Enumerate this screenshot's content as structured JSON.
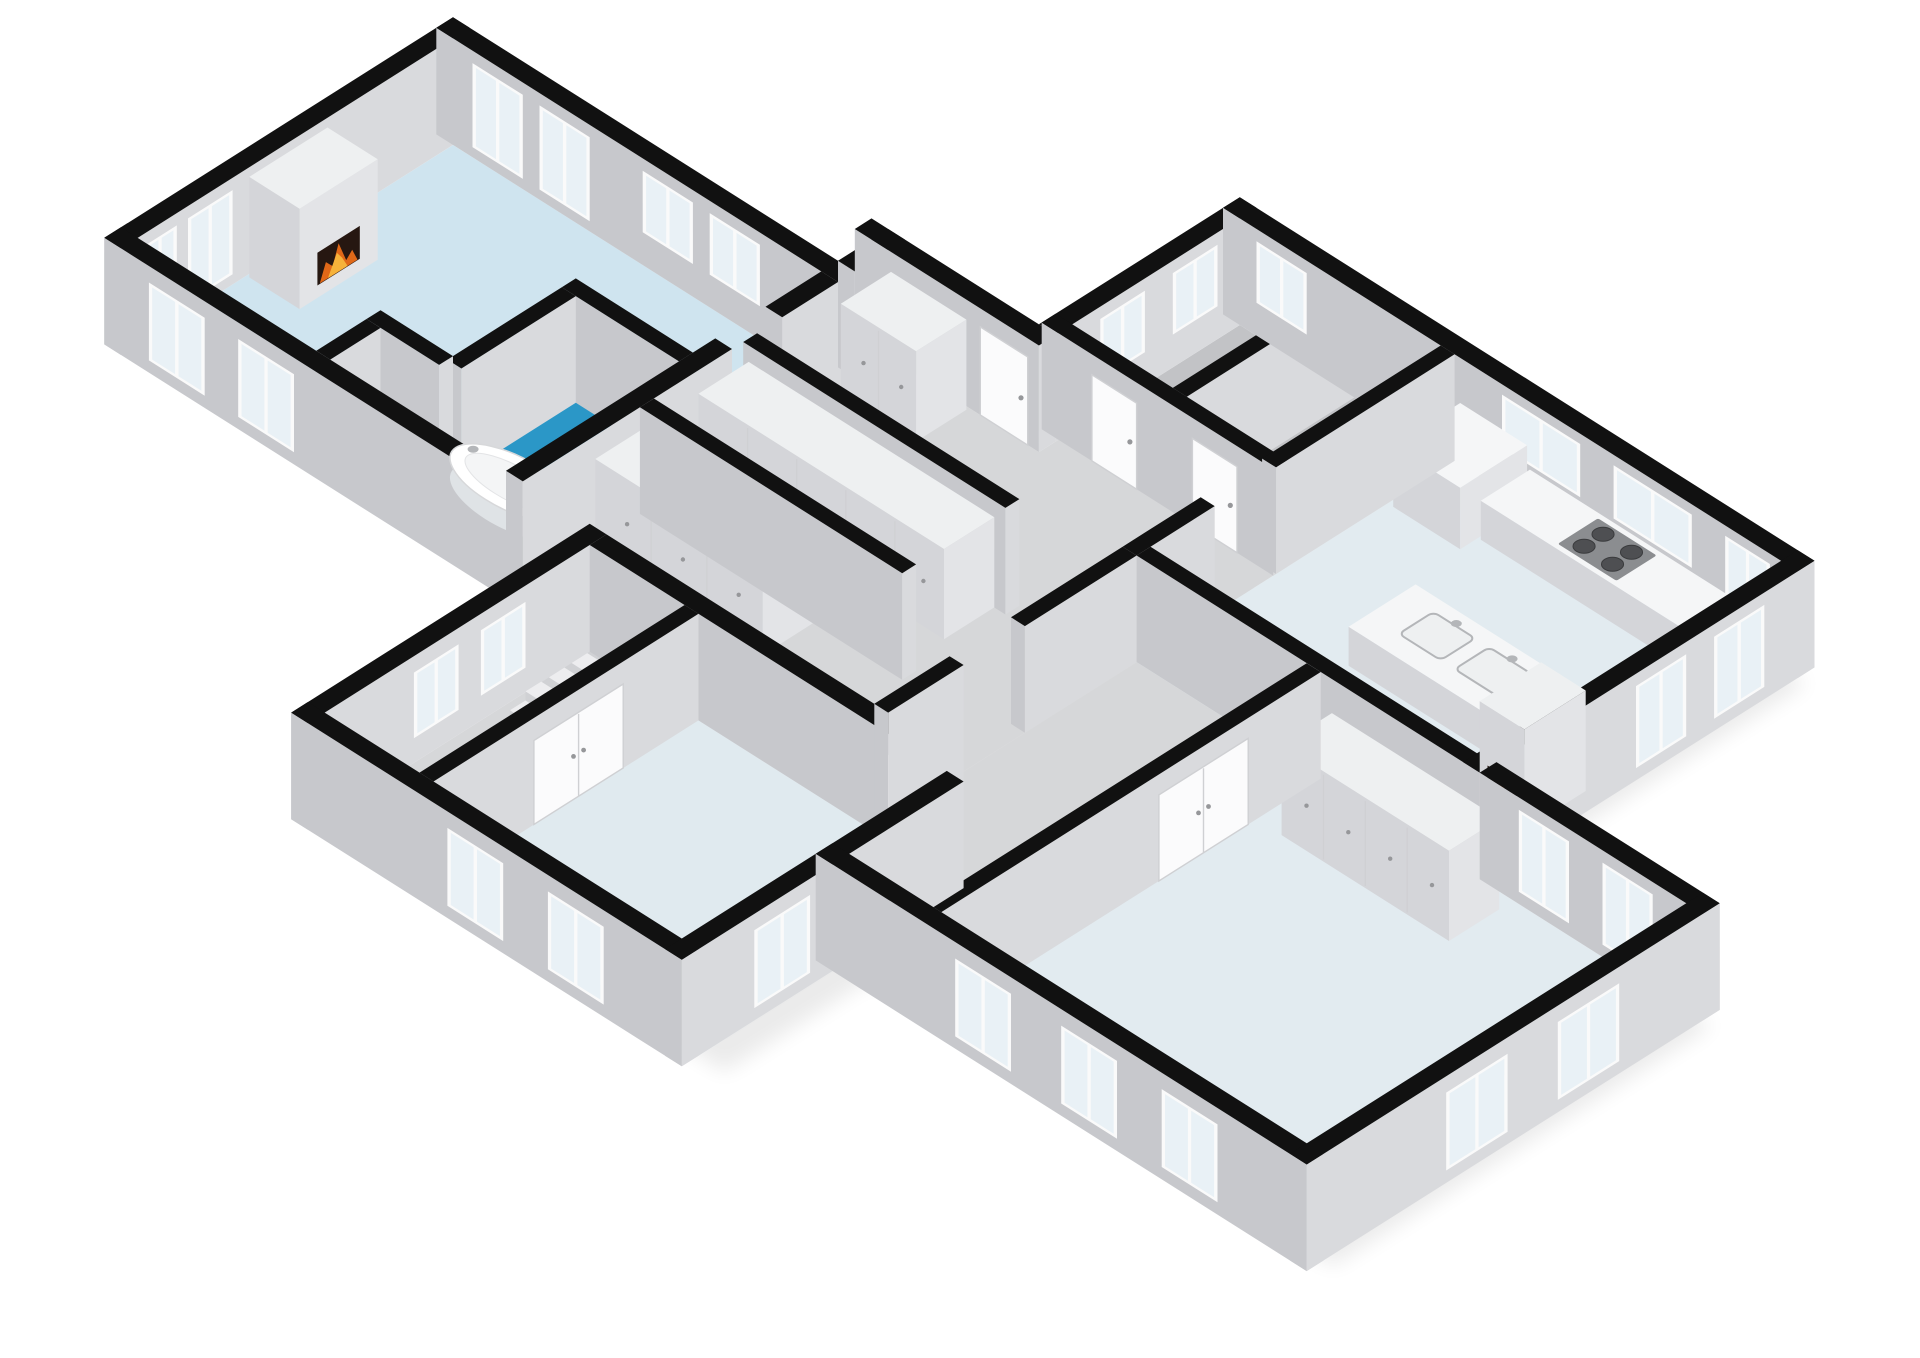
{
  "scene": {
    "kind": "3d-isometric-floor-plan",
    "background": "#ffffff"
  },
  "palette": {
    "background": "#ffffff",
    "wall_top": "#111111",
    "wall_face_se": "#d9dadd",
    "wall_face_sw": "#c7c8cc",
    "furn_top": "#eef0f1",
    "furn_face_se": "#e3e4e7",
    "furn_face_sw": "#d4d5d9",
    "white_top": "#f5f6f7",
    "window_frame": "#fafafa",
    "window_glass": "#e9f1f6",
    "door": "#fbfbfc",
    "door_edge": "#cfd0d3",
    "handle": "#96979a",
    "stove": "#8b8d90",
    "burner": "#4e4f52",
    "steel": "#b4b6b9",
    "basin": "#eef0f1",
    "fire_dark": "#261711",
    "fire_orange": "#e06818",
    "fire_yellow": "#f6b23a",
    "accent_red": "#c4402a",
    "tub_white": "#ffffff",
    "tub_inner": "#f4f5f6",
    "step_top": "#ededef",
    "shadow": "#000000"
  },
  "rooms": [
    {
      "name": "living-room",
      "floor_color": "#cfe4ef"
    },
    {
      "name": "bathroom",
      "floor_color": "#2b97c7"
    },
    {
      "name": "wc",
      "floor_color": "#2b97c7"
    },
    {
      "name": "corridor",
      "floor_color": "#d6d7d9"
    },
    {
      "name": "hallway",
      "floor_color": "#d6d7d9"
    },
    {
      "name": "mid-hall",
      "floor_color": "#d6d7d9"
    },
    {
      "name": "stair-hall",
      "floor_color": "#d6d7d9"
    },
    {
      "name": "storage-left",
      "floor_color": "#c2c3c6"
    },
    {
      "name": "storage-right",
      "floor_color": "#c2c3c6"
    },
    {
      "name": "kitchen",
      "floor_color": "#e2ebf0"
    },
    {
      "name": "bedroom-left",
      "floor_color": "#e0eaef"
    },
    {
      "name": "bedroom-right",
      "floor_color": "#e2ebf0"
    }
  ],
  "fixtures": [
    "fireplace-living-icon",
    "fireplace-kitchen-icon",
    "bathtub",
    "toilet",
    "shower-head-icon",
    "stove-4-burner",
    "kitchen-counter",
    "kitchen-tall-cabinet",
    "kitchen-island",
    "sink-left",
    "sink-right",
    "wardrobe-row-1",
    "wardrobe-row-2",
    "wardrobe-row-3",
    "wardrobe-row-bedroom",
    "stairs",
    "dresser",
    "red-extinguisher"
  ]
}
